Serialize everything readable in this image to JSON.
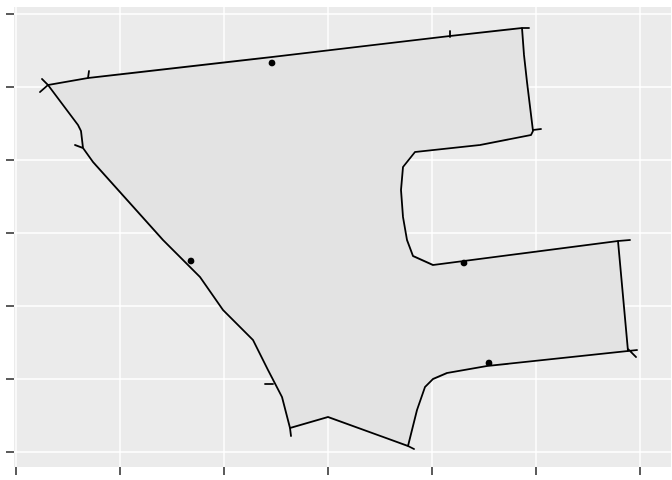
{
  "figure": {
    "width": 672,
    "height": 480,
    "background": "#ffffff",
    "panel": {
      "x": 14,
      "y": 7,
      "width": 657,
      "height": 460,
      "fill": "#ebebeb"
    },
    "grid_color": "#ffffff",
    "grid_width": 1.4,
    "axis_tick_color": "#333333",
    "axis_tick_width": 1.6,
    "axis_tick_length": 8
  },
  "chart_data": {
    "type": "area",
    "title": "",
    "subtitle": "",
    "xlabel": "",
    "ylabel": "",
    "legend": "none",
    "grid": "major-only",
    "tick_labels_visible": false,
    "note": "spatial polygon plot; axes show unlabeled ticks only, coordinates below are screen pixels",
    "x_gridlines_px": [
      16,
      120,
      224,
      328,
      432,
      536,
      640
    ],
    "y_gridlines_px": [
      14,
      87,
      160,
      233,
      306,
      379,
      452
    ],
    "x_axis_ticks_px": [
      16,
      120,
      224,
      328,
      432,
      536,
      640
    ],
    "y_axis_ticks_px": [
      14,
      87,
      160,
      233,
      306,
      379,
      452
    ],
    "polygon": {
      "fill": "#e3e3e3",
      "stroke": "#000000",
      "stroke_width": 1.8,
      "ring_px": [
        [
          48,
          85
        ],
        [
          78,
          125
        ],
        [
          81,
          131
        ],
        [
          83,
          148
        ],
        [
          93,
          162
        ],
        [
          163,
          240
        ],
        [
          200,
          277
        ],
        [
          223,
          310
        ],
        [
          253,
          340
        ],
        [
          268,
          370
        ],
        [
          282,
          397
        ],
        [
          290,
          428
        ],
        [
          328,
          417
        ],
        [
          408,
          446
        ],
        [
          417,
          410
        ],
        [
          425,
          387
        ],
        [
          433,
          379
        ],
        [
          447,
          373
        ],
        [
          487,
          366
        ],
        [
          628,
          351
        ],
        [
          618,
          241
        ],
        [
          433,
          265
        ],
        [
          413,
          256
        ],
        [
          407,
          240
        ],
        [
          403,
          217
        ],
        [
          401,
          190
        ],
        [
          403,
          167
        ],
        [
          415,
          152
        ],
        [
          480,
          145
        ],
        [
          531,
          135
        ],
        [
          533,
          131
        ],
        [
          527,
          82
        ],
        [
          524,
          55
        ],
        [
          522,
          28
        ],
        [
          450,
          36
        ],
        [
          272,
          57
        ],
        [
          88,
          78
        ]
      ]
    },
    "edge_tick_segments_px": [
      [
        [
          48,
          85
        ],
        [
          40,
          92
        ]
      ],
      [
        [
          48,
          85
        ],
        [
          42,
          79
        ]
      ],
      [
        [
          88,
          78
        ],
        [
          89,
          71
        ]
      ],
      [
        [
          83,
          148
        ],
        [
          75,
          145
        ]
      ],
      [
        [
          450,
          37
        ],
        [
          450,
          31
        ]
      ],
      [
        [
          522,
          28
        ],
        [
          529,
          28
        ]
      ],
      [
        [
          533,
          130
        ],
        [
          541,
          129
        ]
      ],
      [
        [
          618,
          241
        ],
        [
          630,
          240
        ]
      ],
      [
        [
          628,
          351
        ],
        [
          637,
          350
        ]
      ],
      [
        [
          628,
          349
        ],
        [
          636,
          357
        ]
      ],
      [
        [
          273,
          384
        ],
        [
          265,
          384
        ]
      ],
      [
        [
          290,
          428
        ],
        [
          291,
          436
        ]
      ],
      [
        [
          408,
          446
        ],
        [
          414,
          449
        ]
      ]
    ],
    "points": {
      "color": "#000000",
      "radius": 3.4,
      "xy_px": [
        [
          272,
          63
        ],
        [
          191,
          261
        ],
        [
          464,
          263
        ],
        [
          489,
          363
        ]
      ]
    }
  }
}
